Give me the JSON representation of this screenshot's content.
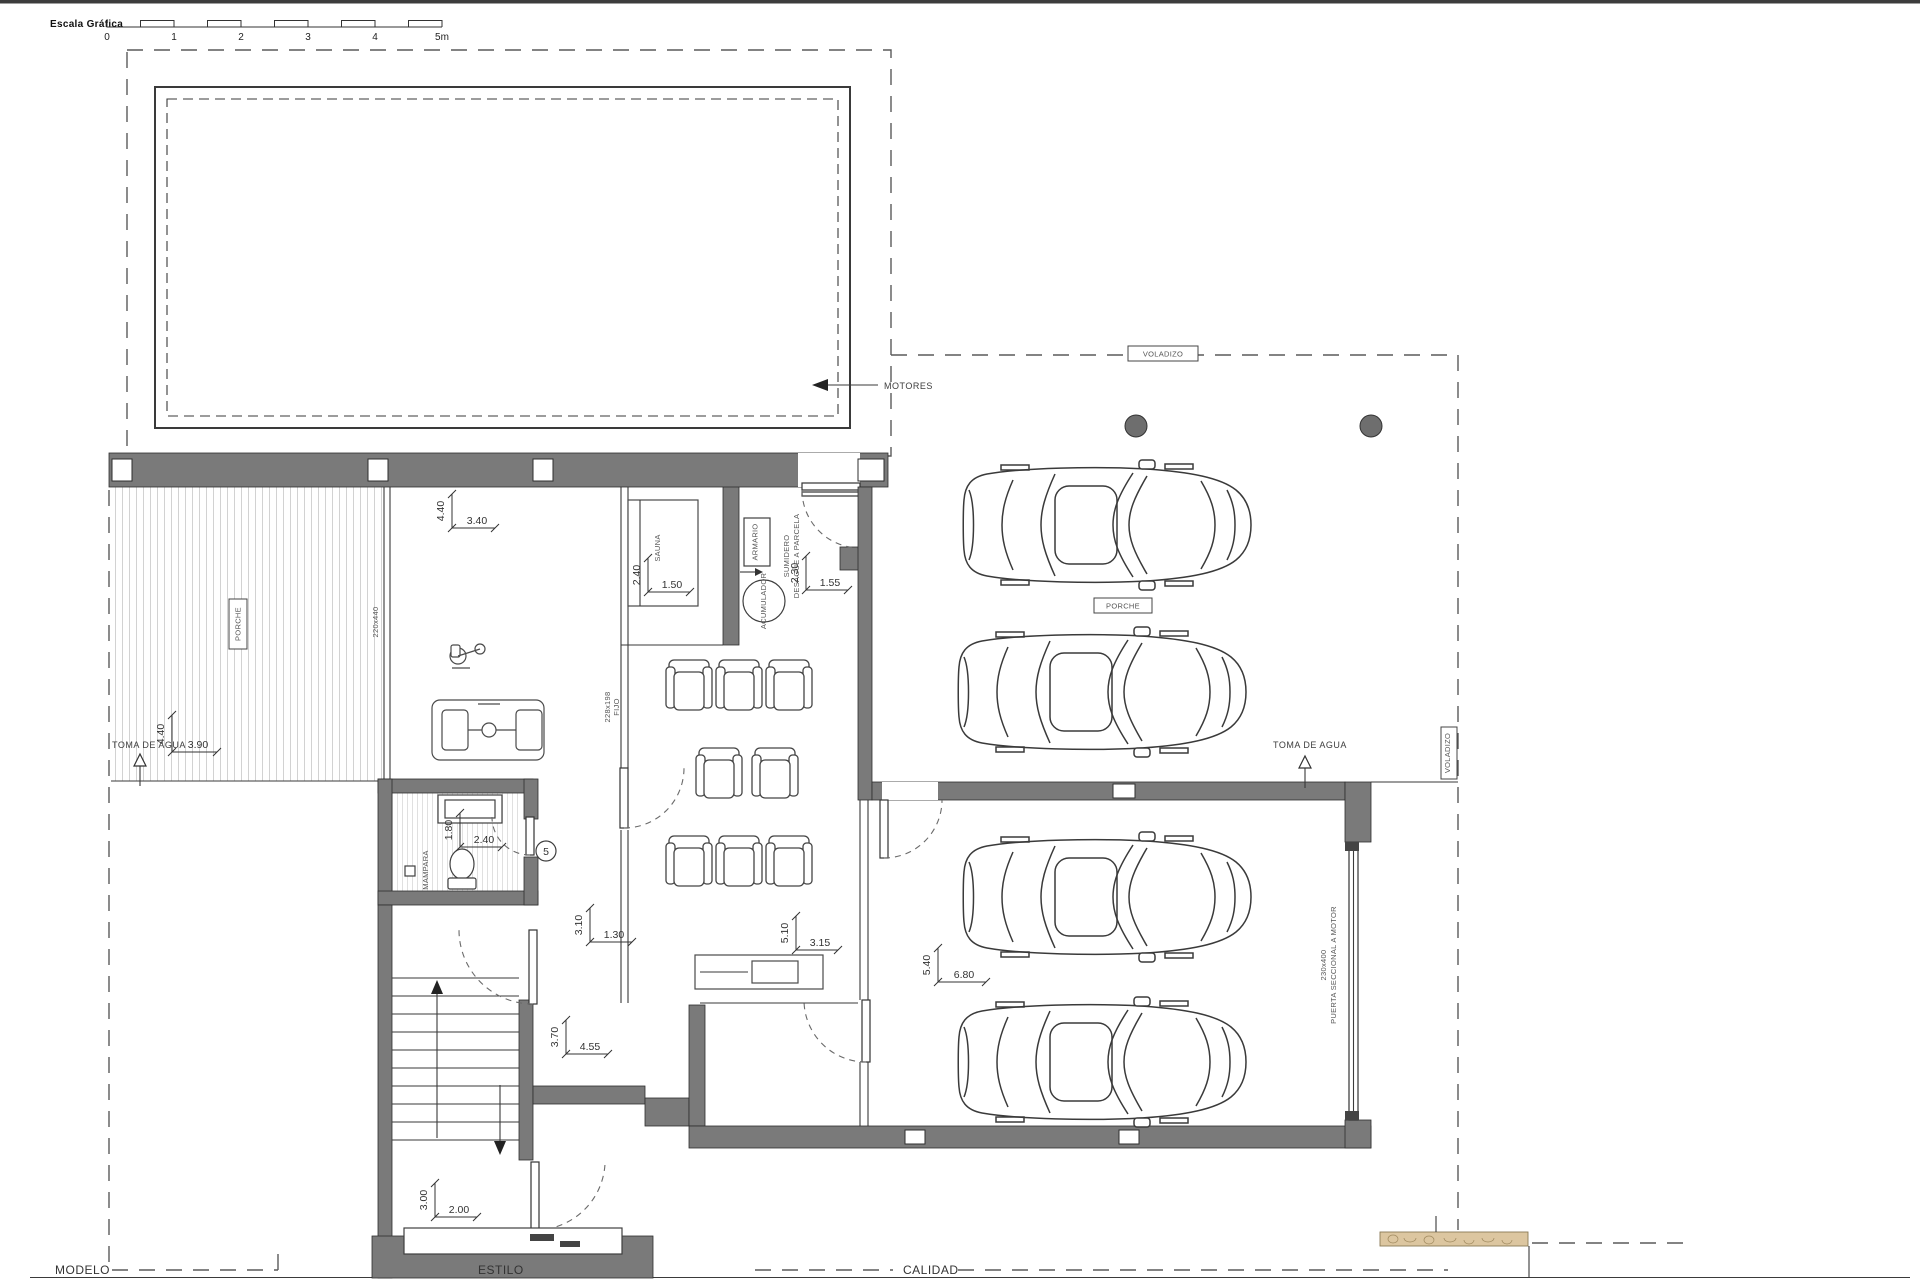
{
  "scale_bar": {
    "title": "Escala Gráfica",
    "ticks": [
      "0",
      "1",
      "2",
      "3",
      "4",
      "5m"
    ]
  },
  "annotations": {
    "motores": "MOTORES",
    "voladizo_top": "VOLADIZO",
    "voladizo_right": "VOLADIZO",
    "porche_left": "PORCHE",
    "porche_terrace": "PORCHE",
    "toma_de_agua_left": "TOMA DE AGUA",
    "toma_de_agua_right": "TOMA DE AGUA",
    "sauna": "SAUNA",
    "armario": "ARMARIO",
    "acumulador": "ACUMULADOR",
    "sumidero_line1": "SUMIDERO",
    "sumidero_line2": "DESAGÜE A PARCELA",
    "mampara": "MAMPARA",
    "keynote": "5",
    "window_gym": "220x440",
    "window_cinema_size": "228x198",
    "window_cinema_type": "FIJO",
    "garage_door_size": "230x400",
    "garage_door_label": "PUERTA SECCIONAL A MOTOR"
  },
  "dims": {
    "porch": {
      "v": "4.40",
      "h": "3.90"
    },
    "gym": {
      "v": "4.40",
      "h": "3.40"
    },
    "sauna": {
      "v": "2.40",
      "h": "1.50"
    },
    "utility": {
      "v": "2.30",
      "h": "1.55"
    },
    "bath": {
      "v": "1.80",
      "h": "2.40"
    },
    "hall": {
      "v": "3.10",
      "h": "1.30"
    },
    "cinema": {
      "v": "5.10",
      "h": "3.15"
    },
    "garage": {
      "v": "5.40",
      "h": "6.80"
    },
    "stairs": {
      "v": "3.70",
      "h": "4.55"
    },
    "vestibule": {
      "v": "3.00",
      "h": "2.00"
    }
  },
  "title_block": {
    "modelo": "MODELO",
    "estilo": "ESTILO",
    "calidad": "CALIDAD"
  }
}
